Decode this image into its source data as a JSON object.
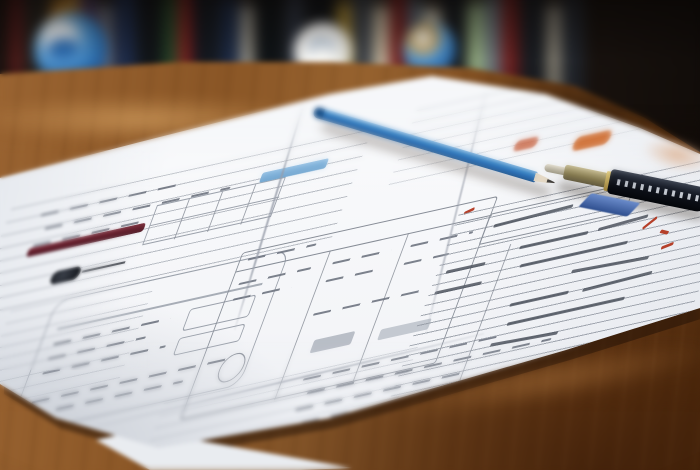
{
  "scene": {
    "description": "Photograph of printed UI wireframe sheets spread on a wooden desk; a blue pencil and a dark pen with white lettering lie across the papers; blurred bookshelf with two earth globes and a white ball in the background",
    "objects": [
      {
        "name": "wireframe-sheets",
        "count": 5,
        "detail": "hand-drawn style UI layouts, ruled lines, tables, placeholder text strokes"
      },
      {
        "name": "blue-pencil",
        "detail": "sharpened, lying diagonally across the sheets"
      },
      {
        "name": "pen",
        "detail": "dark barrel, metal nib, white lettering, blue clip piece beneath"
      },
      {
        "name": "earth-globe-left"
      },
      {
        "name": "white-ball-middle"
      },
      {
        "name": "earth-globe-right"
      },
      {
        "name": "bookshelf",
        "detail": "out-of-focus book spines in many colors"
      },
      {
        "name": "wooden-desk"
      }
    ],
    "colors": {
      "desk_wood": "#8a5626",
      "desk_wood_dark": "#58300f",
      "paper": "#f6f7f9",
      "pencil_blue": "#2f79b8",
      "pen_barrel": "#10141c",
      "pen_clip_blue": "#3f5fa0",
      "sketch_ink": "#8a909a",
      "accent_maroon": "#66222e",
      "accent_blue_bar": "#7fb2da",
      "accent_tan": "#e7d3a6",
      "accent_orange": "#cf6a2c",
      "annotation_red": "#b5402a"
    }
  },
  "background": {
    "book_spines": [
      {
        "c": "#16120f",
        "w": 20,
        "h": 100
      },
      {
        "c": "#5a1a1a",
        "w": 12,
        "h": 96
      },
      {
        "c": "#23201c",
        "w": 26,
        "h": 100
      },
      {
        "c": "#c8872e",
        "w": 14,
        "h": 92
      },
      {
        "c": "#d79a3c",
        "w": 10,
        "h": 97
      },
      {
        "c": "#4a3b60",
        "w": 16,
        "h": 94
      },
      {
        "c": "#6b6f7a",
        "w": 14,
        "h": 88
      },
      {
        "c": "#1d2b4a",
        "w": 22,
        "h": 98
      },
      {
        "c": "#101418",
        "w": 24,
        "h": 100
      },
      {
        "c": "#274a2a",
        "w": 14,
        "h": 95
      },
      {
        "c": "#a32222",
        "w": 10,
        "h": 98
      },
      {
        "c": "#14181f",
        "w": 26,
        "h": 100
      },
      {
        "c": "#1b2a45",
        "w": 20,
        "h": 93
      },
      {
        "c": "#c9c4b4",
        "w": 10,
        "h": 88
      },
      {
        "c": "#0f1316",
        "w": 30,
        "h": 100
      },
      {
        "c": "#2c3340",
        "w": 18,
        "h": 96
      },
      {
        "c": "#101317",
        "w": 30,
        "h": 100
      },
      {
        "c": "#caa43a",
        "w": 12,
        "h": 90
      },
      {
        "c": "#3a4049",
        "w": 20,
        "h": 97
      },
      {
        "c": "#d9cdb0",
        "w": 14,
        "h": 88
      },
      {
        "c": "#7a1f1f",
        "w": 16,
        "h": 98
      },
      {
        "c": "#5b6b7a",
        "w": 14,
        "h": 92
      },
      {
        "c": "#d9d2bd",
        "w": 16,
        "h": 86
      },
      {
        "c": "#15191e",
        "w": 24,
        "h": 100
      },
      {
        "c": "#9db88a",
        "w": 16,
        "h": 90
      },
      {
        "c": "#6e7a84",
        "w": 14,
        "h": 94
      },
      {
        "c": "#7a2020",
        "w": 16,
        "h": 98
      },
      {
        "c": "#1a1e24",
        "w": 26,
        "h": 100
      },
      {
        "c": "#b8b2a0",
        "w": 12,
        "h": 88
      },
      {
        "c": "#262c35",
        "w": 22,
        "h": 96
      }
    ]
  }
}
